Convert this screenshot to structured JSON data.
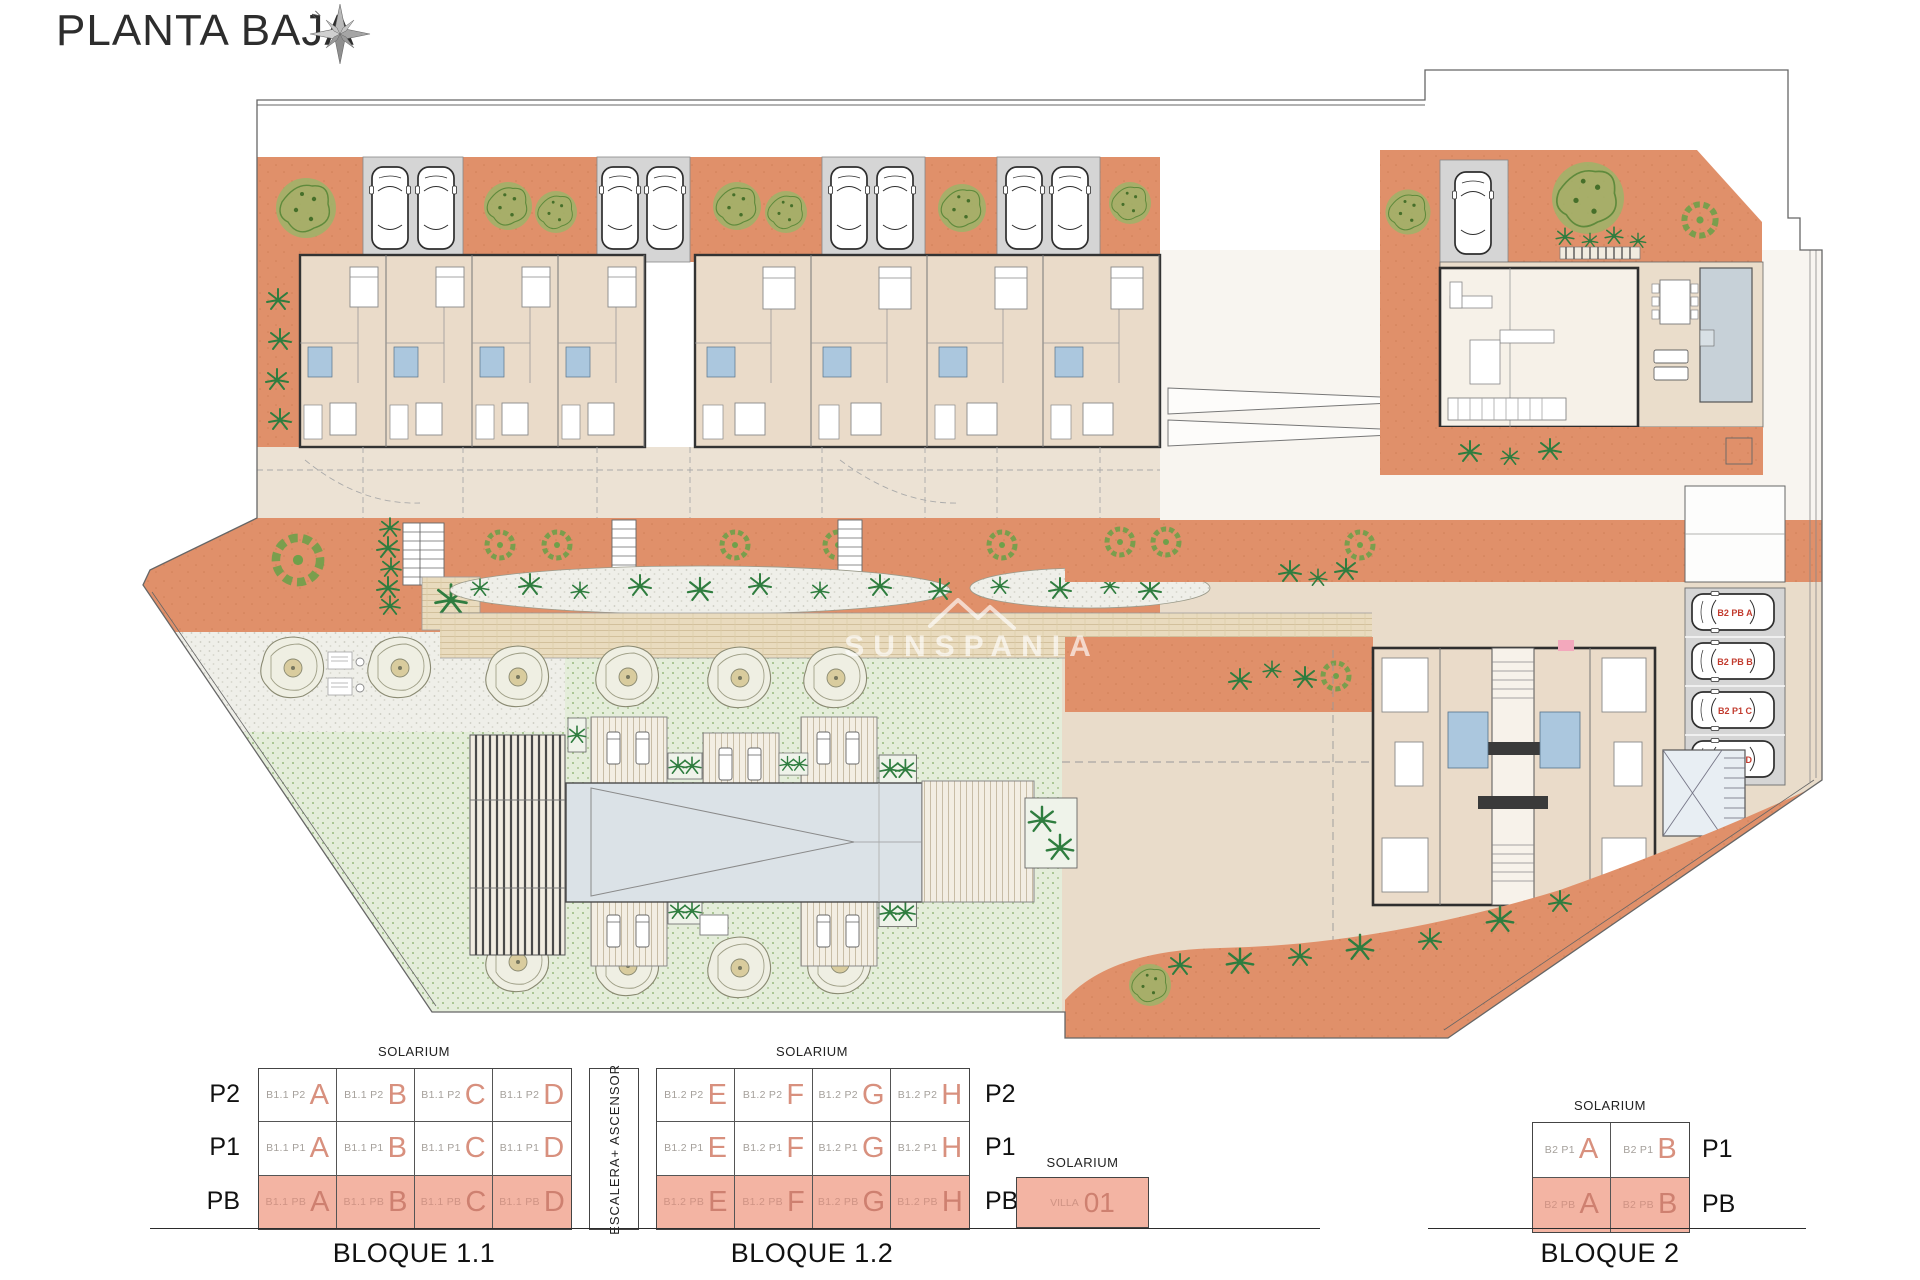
{
  "title": "PLANTA BAJA",
  "compass": {
    "north": "N"
  },
  "watermark": "SUNSPANIA",
  "colors": {
    "terracotta": "#e0906a",
    "apartment_floor": "#eadbc9",
    "garage_gray": "#d5d5d5",
    "bath_blue": "#abc7de",
    "pool": "#dbe2e7",
    "villa_pool": "#c7d1d8",
    "lawn": "#e4edda",
    "walkway": "#e9dbbe",
    "legend_pb_fill": "#f3b4a3",
    "legend_letter": "#d8907e",
    "legend_code_gray": "#a5a09b",
    "parking_label_red": "#c23b2e"
  },
  "site_plan": {
    "parking_labels": [
      "B2 PB A",
      "B2 PB B",
      "B2 P1 C",
      "B2 P1 D"
    ]
  },
  "legend": {
    "solarium": "SOLARIUM",
    "stair_column": "ESCALERA+ ASCENSOR",
    "floors3": [
      "P2",
      "P1",
      "PB"
    ],
    "floors2": [
      "P1",
      "PB"
    ],
    "bloque11": {
      "caption": "BLOQUE 1.1",
      "rows": [
        {
          "cells": [
            {
              "code": "B1.1 P2",
              "letter": "A"
            },
            {
              "code": "B1.1 P2",
              "letter": "B"
            },
            {
              "code": "B1.1 P2",
              "letter": "C"
            },
            {
              "code": "B1.1 P2",
              "letter": "D"
            }
          ]
        },
        {
          "cells": [
            {
              "code": "B1.1 P1",
              "letter": "A"
            },
            {
              "code": "B1.1 P1",
              "letter": "B"
            },
            {
              "code": "B1.1 P1",
              "letter": "C"
            },
            {
              "code": "B1.1 P1",
              "letter": "D"
            }
          ]
        },
        {
          "cells": [
            {
              "code": "B1.1 PB",
              "letter": "A"
            },
            {
              "code": "B1.1 PB",
              "letter": "B"
            },
            {
              "code": "B1.1 PB",
              "letter": "C"
            },
            {
              "code": "B1.1 PB",
              "letter": "D"
            }
          ]
        }
      ]
    },
    "bloque12": {
      "caption": "BLOQUE 1.2",
      "rows": [
        {
          "cells": [
            {
              "code": "B1.2 P2",
              "letter": "E"
            },
            {
              "code": "B1.2 P2",
              "letter": "F"
            },
            {
              "code": "B1.2 P2",
              "letter": "G"
            },
            {
              "code": "B1.2 P2",
              "letter": "H"
            }
          ]
        },
        {
          "cells": [
            {
              "code": "B1.2 P1",
              "letter": "E"
            },
            {
              "code": "B1.2 P1",
              "letter": "F"
            },
            {
              "code": "B1.2 P1",
              "letter": "G"
            },
            {
              "code": "B1.2 P1",
              "letter": "H"
            }
          ]
        },
        {
          "cells": [
            {
              "code": "B1.2 PB",
              "letter": "E"
            },
            {
              "code": "B1.2 PB",
              "letter": "F"
            },
            {
              "code": "B1.2 PB",
              "letter": "G"
            },
            {
              "code": "B1.2 PB",
              "letter": "H"
            }
          ]
        }
      ]
    },
    "villa": {
      "code": "VILLA",
      "number": "01"
    },
    "bloque2": {
      "caption": "BLOQUE 2",
      "rows": [
        {
          "cells": [
            {
              "code": "B2 P1",
              "letter": "A"
            },
            {
              "code": "B2 P1",
              "letter": "B"
            }
          ]
        },
        {
          "cells": [
            {
              "code": "B2 PB",
              "letter": "A"
            },
            {
              "code": "B2 PB",
              "letter": "B"
            }
          ]
        }
      ]
    }
  }
}
